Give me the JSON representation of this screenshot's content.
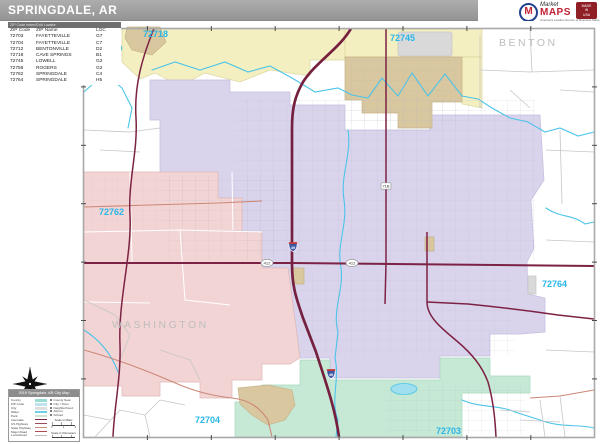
{
  "header": {
    "title": "SPRINGDALE, AR"
  },
  "logo": {
    "brand_top": "Market",
    "brand_main": "MAPS",
    "tagline": "America's Leading Source of Business Maps",
    "badge_lines": [
      "MADE",
      "IN",
      "USA"
    ]
  },
  "zip_index": {
    "strip_title": "ZIP Code Index/Grid Locator",
    "columns": [
      "ZIP Code",
      "ZIP Name",
      "LOC"
    ],
    "rows": [
      {
        "zip": "72703",
        "name": "FAYETTEVILLE",
        "loc": "G7"
      },
      {
        "zip": "72704",
        "name": "FAYETTEVILLE",
        "loc": "C7"
      },
      {
        "zip": "72712",
        "name": "BENTONVILLE",
        "loc": "D2"
      },
      {
        "zip": "72718",
        "name": "CAVE SPRINGS",
        "loc": "B1"
      },
      {
        "zip": "72745",
        "name": "LOWELL",
        "loc": "G2"
      },
      {
        "zip": "72756",
        "name": "ROGERS",
        "loc": "G2"
      },
      {
        "zip": "72762",
        "name": "SPRINGDALE",
        "loc": "C4"
      },
      {
        "zip": "72764",
        "name": "SPRINGDALE",
        "loc": "H5"
      }
    ]
  },
  "map": {
    "zip_labels": [
      {
        "text": "72718",
        "x": 143,
        "y": 37
      },
      {
        "text": "72712",
        "x": 86,
        "y": 58
      },
      {
        "text": "72745",
        "x": 390,
        "y": 41
      },
      {
        "text": "72762",
        "x": 99,
        "y": 215
      },
      {
        "text": "72764",
        "x": 542,
        "y": 287
      },
      {
        "text": "72704",
        "x": 195,
        "y": 423
      },
      {
        "text": "72703",
        "x": 436,
        "y": 434
      }
    ],
    "county_labels": [
      {
        "text": "BENTON",
        "x": 499,
        "y": 46
      },
      {
        "text": "WASHINGTON",
        "x": 112,
        "y": 328
      }
    ],
    "shields": [
      {
        "text": "49",
        "x": 293,
        "y": 247,
        "type": "interstate"
      },
      {
        "text": "49",
        "x": 331,
        "y": 374,
        "type": "interstate"
      },
      {
        "text": "412",
        "x": 267,
        "y": 263,
        "type": "oval"
      },
      {
        "text": "412",
        "x": 352,
        "y": 263,
        "type": "oval"
      },
      {
        "text": "71B",
        "x": 386,
        "y": 186,
        "type": "rect"
      }
    ],
    "colors": {
      "zip_72718_yellow": "#f3efc0",
      "zip_72762_pink": "#f3d4d4",
      "zip_72764_lavender": "#d9d4ec",
      "zip_72703_mint": "#c6e9d6",
      "city_area_tan": "#d8c79f",
      "interstate": "#7c2244",
      "stream": "#4cc4e9",
      "zip_label": "#28b6e8"
    }
  },
  "legend": {
    "title": "2019 Springdale, AR City Map",
    "items": [
      {
        "label": "County",
        "color": "#9adbd2",
        "kind": "fill"
      },
      {
        "label": "ZIP Code",
        "color": "#bfe4f0",
        "kind": "fill"
      },
      {
        "label": "City",
        "color": "#e0e0e0",
        "kind": "fill"
      },
      {
        "label": "Water",
        "color": "#6fd0ea",
        "kind": "fill"
      },
      {
        "label": "Park",
        "color": "#cde6cf",
        "kind": "fill"
      },
      {
        "label": "Interstate",
        "color": "#7c2244",
        "kind": "line"
      },
      {
        "label": "US Highway",
        "color": "#9c4a5e",
        "kind": "line"
      },
      {
        "label": "State Highway",
        "color": "#cf8f7e",
        "kind": "line"
      },
      {
        "label": "Major Road",
        "color": "#b04a52",
        "kind": "line"
      },
      {
        "label": "Local Road",
        "color": "#bdbdbd",
        "kind": "line"
      }
    ],
    "symbols": [
      {
        "label": "County Seat"
      },
      {
        "label": "City / Town"
      },
      {
        "label": "Neighborhood"
      },
      {
        "label": "Airport"
      },
      {
        "label": "School"
      }
    ],
    "scale_miles_label": "Scale in Miles",
    "scale_km_label": "Scale in Kilometers",
    "scale_values": [
      "0",
      "1",
      "2"
    ]
  }
}
